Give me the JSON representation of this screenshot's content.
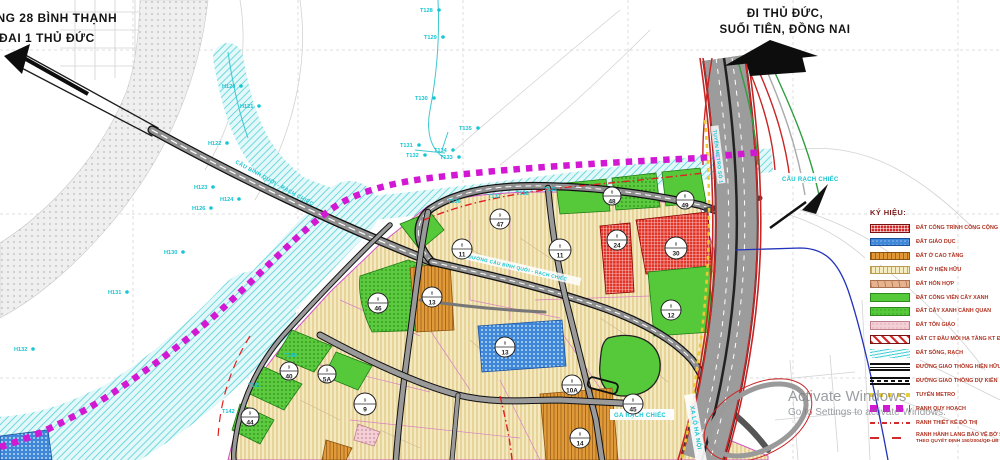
{
  "title_left": {
    "line1": "ỨNG 28 BÌNH THẠNH",
    "line2": "H ĐAI 1 THỦ ĐỨC"
  },
  "title_right": {
    "line1": "ĐI THỦ ĐỨC,",
    "line2": "SUỐI TIÊN, ĐỒNG NAI"
  },
  "legend": {
    "title": "KÝ HIỆU:",
    "items": [
      {
        "label": "ĐẤT CÔNG TRÌNH CÔNG CỘNG"
      },
      {
        "label": "ĐẤT GIÁO DỤC"
      },
      {
        "label": "ĐẤT Ở CAO TẦNG"
      },
      {
        "label": "ĐẤT Ở HIỆN HỮU"
      },
      {
        "label": "ĐẤT HỖN HỢP"
      },
      {
        "label": "ĐẤT CÔNG VIÊN CÂY XANH"
      },
      {
        "label": "ĐẤT CÂY XANH CẢNH QUAN"
      },
      {
        "label": "ĐẤT TÔN GIÁO"
      },
      {
        "label": "ĐẤT CT ĐẦU MỐI HẠ TẦNG KT ĐÔ THỊ"
      },
      {
        "label": "ĐẤT SÔNG, RẠCH"
      },
      {
        "label": "ĐƯỜNG GIAO THÔNG HIỆN HỮU"
      },
      {
        "label": "ĐƯỜNG GIAO THÔNG DỰ KIẾN"
      },
      {
        "label": "TUYẾN METRO"
      },
      {
        "label": "RANH QUY HOẠCH"
      },
      {
        "label": "RANH THIẾT KẾ ĐÔ THỊ"
      },
      {
        "label": "RANH HÀNH LANG BẢO VỆ BỜ SÔNG, KÊNH RẠCH",
        "label2": "THEO QUYẾT ĐỊNH 150/2004/QĐ-UB NGÀY 9/6/2004"
      }
    ]
  },
  "map": {
    "road_labels": [
      {
        "text": "CẦU BÌNH QUỚI - RẠCH CHIẾC"
      },
      {
        "text": "ĐƯỜNG CẦU BÌNH QUỚI - RẠCH CHIẾC"
      },
      {
        "text": "CẦU RẠCH CHIẾC"
      },
      {
        "text": "GA RẠCH CHIẾC"
      },
      {
        "text": "XA LỘ HÀ NỘI"
      },
      {
        "text": "TUYẾN METRO SỐ 1"
      }
    ],
    "point_labels": [
      {
        "text": "H120"
      },
      {
        "text": "H121"
      },
      {
        "text": "H122"
      },
      {
        "text": "H123"
      },
      {
        "text": "H124"
      },
      {
        "text": "H126"
      },
      {
        "text": "H130"
      },
      {
        "text": "H131"
      },
      {
        "text": "H132"
      },
      {
        "text": "T128"
      },
      {
        "text": "T129"
      },
      {
        "text": "T130"
      },
      {
        "text": "T135"
      },
      {
        "text": "T131"
      },
      {
        "text": "T134"
      },
      {
        "text": "T132"
      },
      {
        "text": "T133"
      },
      {
        "text": "T136"
      },
      {
        "text": "T137"
      },
      {
        "text": "T138"
      },
      {
        "text": "T139"
      },
      {
        "text": "T140"
      },
      {
        "text": "T141"
      },
      {
        "text": "T142"
      }
    ],
    "badges": [
      {
        "top": "9",
        "bottom": "47"
      },
      {
        "top": "8",
        "bottom": "11"
      },
      {
        "top": "8",
        "bottom": "11"
      },
      {
        "top": "8",
        "bottom": "13"
      },
      {
        "top": "9",
        "bottom": "46"
      },
      {
        "top": "8",
        "bottom": "13"
      },
      {
        "top": "8",
        "bottom": "24"
      },
      {
        "top": "8",
        "bottom": "30"
      },
      {
        "top": "8",
        "bottom": "48"
      },
      {
        "top": "8",
        "bottom": "49"
      },
      {
        "top": "8",
        "bottom": "12"
      },
      {
        "top": "8",
        "bottom": "10A"
      },
      {
        "top": "8",
        "bottom": "45"
      },
      {
        "top": "8",
        "bottom": "14"
      },
      {
        "top": "9",
        "bottom": "9"
      },
      {
        "top": "9",
        "bottom": "40"
      },
      {
        "top": "9",
        "bottom": "5A"
      },
      {
        "top": "9",
        "bottom": "44"
      }
    ]
  },
  "watermark": {
    "line1": "Activate Windows",
    "line2": "Go to Settings to activate Windows."
  },
  "colors": {
    "boundary_magenta": "#d318d3",
    "river_cyan": "#52d0d8",
    "park_green": "#56c93b",
    "public_red": "#d42a2a",
    "education_blue": "#3f87d8",
    "highrise_orange": "#df9737",
    "existing_yellow": "#f4e9c0",
    "legend_text": "#b03322"
  }
}
